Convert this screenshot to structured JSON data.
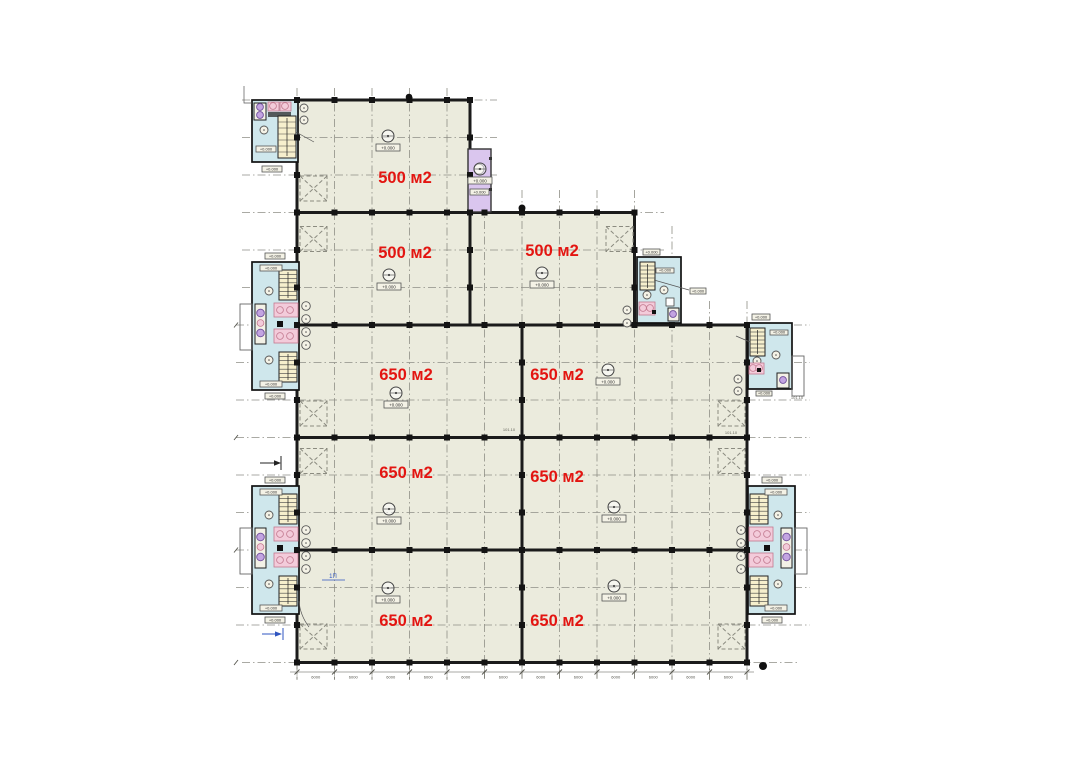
{
  "plan": {
    "colors": {
      "floor": "#ebebdd",
      "wall": "#1b1b1b",
      "grid_line": "#8f8f86",
      "core_room": "#cfe7ec",
      "stair_flight": "#f6efcd",
      "fixture_pink": "#f3cbda",
      "fixture_pink_edge": "#c2798f",
      "fixture_purple": "#c3a4e1",
      "fixture_purple_edge": "#6f4f9b",
      "elevator_shaft": "#dac6ee",
      "area_label": "#e31511",
      "annotation_blue": "#2f55c0",
      "dimension_text": "#55554d",
      "tag_fill": "#f4f2e6",
      "hatch_gray": "#8b8b80"
    },
    "area_labels": [
      {
        "text": "500 м2",
        "x": 405,
        "y": 183
      },
      {
        "text": "500 м2",
        "x": 405,
        "y": 258
      },
      {
        "text": "500 м2",
        "x": 552,
        "y": 256
      },
      {
        "text": "650 м2",
        "x": 406,
        "y": 380
      },
      {
        "text": "650 м2",
        "x": 557,
        "y": 380
      },
      {
        "text": "650 м2",
        "x": 406,
        "y": 478
      },
      {
        "text": "650 м2",
        "x": 557,
        "y": 482
      },
      {
        "text": "650 м2",
        "x": 406,
        "y": 626
      },
      {
        "text": "650 м2",
        "x": 557,
        "y": 626
      }
    ],
    "level_marks": [
      {
        "x": 388,
        "y": 136,
        "label": "+0.000"
      },
      {
        "x": 480,
        "y": 169,
        "label": "+0.000"
      },
      {
        "x": 389,
        "y": 275,
        "label": "+0.000"
      },
      {
        "x": 542,
        "y": 273,
        "label": "+0.000"
      },
      {
        "x": 396,
        "y": 393,
        "label": "+0.000"
      },
      {
        "x": 608,
        "y": 370,
        "label": "+0.000"
      },
      {
        "x": 389,
        "y": 509,
        "label": "+0.000"
      },
      {
        "x": 614,
        "y": 507,
        "label": "+0.000"
      },
      {
        "x": 388,
        "y": 588,
        "label": "+0.000"
      },
      {
        "x": 614,
        "y": 586,
        "label": "+0.000"
      }
    ],
    "core_level_label": "+0.000",
    "dimension_row": {
      "bay_label": "6000",
      "bay_count": 12
    },
    "room_tags": [
      {
        "text": "101.10",
        "x": 509,
        "y": 431
      },
      {
        "text": "101.10",
        "x": 731,
        "y": 434
      },
      {
        "text": "101.10",
        "x": 797,
        "y": 399
      }
    ],
    "section_mark_label": {
      "text": "1П",
      "x": 333,
      "y": 578
    }
  }
}
